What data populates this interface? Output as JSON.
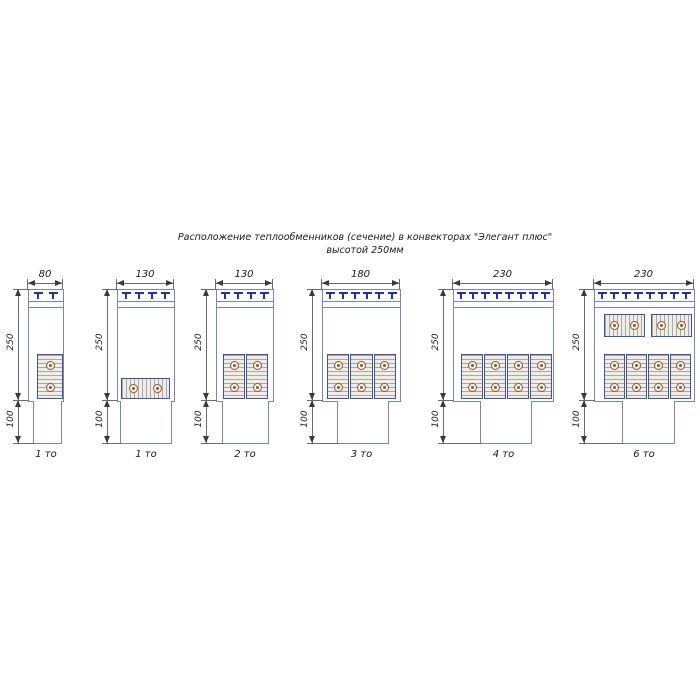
{
  "title": {
    "line1": "Расположение теплообменников (сечение) в конвекторах \"Элегант плюс\"",
    "line2": "высотой 250мм"
  },
  "dims": {
    "body_height": "250",
    "duct_height": "100"
  },
  "diagrams": [
    {
      "width": "80",
      "units": "1 то",
      "tees": 2,
      "heat_exchangers": 1,
      "arrangement": "one vertical block, 2 tubes"
    },
    {
      "width": "130",
      "units": "1 то",
      "tees": 4,
      "heat_exchangers": 1,
      "arrangement": "one horizontal block, 2 tubes"
    },
    {
      "width": "130",
      "units": "2 то",
      "tees": 4,
      "heat_exchangers": 2,
      "arrangement": "two vertical blocks, 2 tubes each"
    },
    {
      "width": "180",
      "units": "3 то",
      "tees": 6,
      "heat_exchangers": 3,
      "arrangement": "three vertical blocks, 2 tubes each"
    },
    {
      "width": "230",
      "units": "4 то",
      "tees": 8,
      "heat_exchangers": 4,
      "arrangement": "four vertical blocks, 2 tubes each"
    },
    {
      "width": "230",
      "units": "6 то",
      "tees": 8,
      "heat_exchangers": 6,
      "arrangement": "two horizontal blocks on top, four vertical blocks below"
    }
  ],
  "colors": {
    "outline_blue": "#7585bd",
    "tee_navy": "#2b2f9b",
    "exchanger_border": "#4350a5",
    "tube_brown": "#8a5540",
    "dimension_gray": "#6b6b6b",
    "text": "#1a1a1a"
  }
}
